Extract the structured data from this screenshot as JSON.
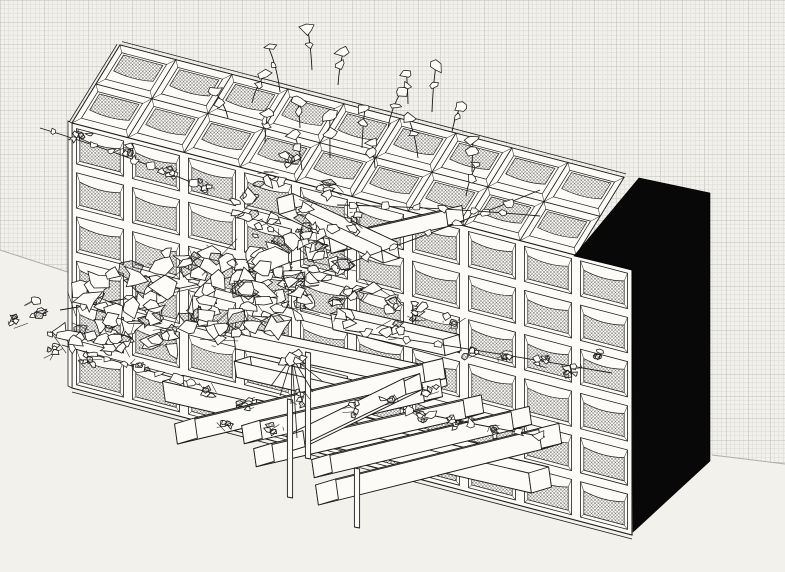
{
  "scene": {
    "canvas": {
      "width": 785,
      "height": 572
    },
    "palette": {
      "paper": "#f2f1ec",
      "grid_minor": "#dbdad5",
      "grid_major": "#c7c6c0",
      "ink": "#1c1c1c",
      "white": "#fcfbf8",
      "leaf_fill": "#fdfcf9",
      "mesh_line": "#454545",
      "monolith": "#080808",
      "ground_line": "#aeada9"
    },
    "background": {
      "grid_region": [
        [
          0,
          0
        ],
        [
          785,
          0
        ],
        [
          785,
          464
        ],
        [
          712,
          455
        ],
        [
          633,
          530
        ],
        [
          90,
          279
        ],
        [
          0,
          250
        ]
      ],
      "grid_cell": 22,
      "grid_minor_step": 4.4,
      "ground_left": [
        [
          0,
          250
        ],
        [
          80,
          276
        ]
      ],
      "ground_right": [
        [
          712,
          455
        ],
        [
          785,
          464
        ]
      ]
    },
    "building": {
      "origin": [
        72,
        123
      ],
      "col_vec": [
        56,
        14.7
      ],
      "row_vec": [
        0,
        44.17
      ],
      "cols": 10,
      "rows": 6,
      "depth_vec": [
        48,
        -78
      ],
      "tray_cols": 9,
      "tray_rows": 2,
      "monolith": [
        [
          574,
          256
        ],
        [
          639,
          178
        ],
        [
          710,
          193
        ],
        [
          710,
          461
        ],
        [
          633,
          532
        ],
        [
          632,
          270
        ]
      ]
    },
    "beams": {
      "parallel": [
        {
          "e": [
            452,
            345
          ],
          "a": 193,
          "l": 115,
          "s": 8
        },
        {
          "e": [
            438,
            380
          ],
          "a": 192,
          "l": 200,
          "s": 8
        },
        {
          "e": [
            370,
            396
          ],
          "a": 193,
          "l": 130,
          "s": 8
        },
        {
          "e": [
            476,
            458
          ],
          "a": 193,
          "l": 310,
          "s": 10
        },
        {
          "e": [
            540,
            480
          ],
          "a": 193,
          "l": 300,
          "s": 10
        }
      ],
      "protruding": [
        {
          "e": [
            186,
            431
          ],
          "a": -13.5,
          "l": 255,
          "s": 10
        },
        {
          "e": [
            252,
            432
          ],
          "a": -13,
          "l": 185,
          "s": 9
        },
        {
          "e": [
            264,
            455
          ],
          "a": -13,
          "l": 215,
          "s": 9
        },
        {
          "e": [
            296,
            441
          ],
          "a": -26,
          "l": 130,
          "s": 8
        },
        {
          "e": [
            322,
            466
          ],
          "a": -13.5,
          "l": 205,
          "s": 9
        },
        {
          "e": [
            327,
            492
          ],
          "a": -14,
          "l": 230,
          "s": 10
        },
        {
          "e": [
            338,
            243
          ],
          "a": -13,
          "l": 120,
          "s": 8
        },
        {
          "e": [
            286,
            204
          ],
          "a": 25,
          "l": 115,
          "s": 8
        }
      ],
      "posts": [
        [
          290,
          399,
          497
        ],
        [
          308,
          352,
          458
        ],
        [
          357,
          468,
          527
        ]
      ]
    },
    "umbrella": {
      "center": [
        292,
        357
      ],
      "tips": [
        [
          271,
          386
        ],
        [
          280,
          396
        ],
        [
          291,
          404
        ],
        [
          302,
          401
        ],
        [
          313,
          392
        ],
        [
          322,
          381
        ],
        [
          297,
          438
        ]
      ]
    },
    "vegetation": {
      "clusters": [
        [
          95,
          300,
          30
        ],
        [
          140,
          285,
          32
        ],
        [
          185,
          272,
          32
        ],
        [
          230,
          262,
          34
        ],
        [
          275,
          252,
          34
        ],
        [
          315,
          248,
          30
        ],
        [
          290,
          280,
          30
        ],
        [
          245,
          292,
          32
        ],
        [
          198,
          308,
          30
        ],
        [
          152,
          318,
          28
        ],
        [
          108,
          325,
          26
        ],
        [
          70,
          338,
          22
        ],
        [
          330,
          270,
          26
        ],
        [
          355,
          290,
          18
        ],
        [
          220,
          330,
          24
        ],
        [
          170,
          340,
          22
        ],
        [
          120,
          345,
          20
        ],
        [
          260,
          320,
          26
        ],
        [
          300,
          305,
          24
        ],
        [
          345,
          310,
          20
        ],
        [
          38,
          308,
          14
        ],
        [
          18,
          322,
          10
        ],
        [
          52,
          352,
          12
        ],
        [
          250,
          208,
          20
        ],
        [
          268,
          182,
          16
        ],
        [
          288,
          158,
          14
        ],
        [
          270,
          230,
          18
        ],
        [
          305,
          210,
          16
        ],
        [
          330,
          190,
          14
        ],
        [
          310,
          235,
          16
        ],
        [
          352,
          222,
          14
        ],
        [
          385,
          300,
          16
        ],
        [
          420,
          312,
          14
        ],
        [
          455,
          322,
          12
        ],
        [
          390,
          330,
          14
        ],
        [
          572,
          368,
          10
        ],
        [
          600,
          352,
          8
        ],
        [
          545,
          362,
          8
        ],
        [
          470,
          352,
          8
        ],
        [
          505,
          358,
          8
        ],
        [
          420,
          415,
          9
        ],
        [
          455,
          422,
          9
        ],
        [
          495,
          430,
          8
        ],
        [
          205,
          390,
          12
        ],
        [
          248,
          402,
          10
        ],
        [
          300,
          398,
          10
        ],
        [
          350,
          408,
          10
        ],
        [
          390,
          400,
          9
        ],
        [
          430,
          392,
          9
        ],
        [
          225,
          425,
          9
        ],
        [
          275,
          430,
          9
        ],
        [
          90,
          360,
          12
        ],
        [
          140,
          365,
          10
        ],
        [
          85,
          135,
          10
        ],
        [
          125,
          152,
          10
        ],
        [
          168,
          172,
          10
        ],
        [
          205,
          188,
          10
        ]
      ],
      "roof_sprigs": [
        [
          228,
          118
        ],
        [
          252,
          103
        ],
        [
          280,
          92
        ],
        [
          312,
          70
        ],
        [
          338,
          85
        ],
        [
          300,
          128
        ],
        [
          265,
          142
        ],
        [
          330,
          158
        ],
        [
          362,
          148
        ],
        [
          388,
          128
        ],
        [
          408,
          104
        ],
        [
          432,
          112
        ],
        [
          452,
          132
        ],
        [
          375,
          168
        ],
        [
          302,
          170
        ],
        [
          418,
          158
        ],
        [
          472,
          172
        ],
        [
          466,
          196
        ]
      ],
      "vines": [
        [
          [
            323,
            272
          ],
          [
            430,
            235
          ],
          [
            540,
            190
          ]
        ],
        [
          [
            337,
            205
          ],
          [
            440,
            207
          ],
          [
            540,
            216
          ]
        ],
        [
          [
            60,
            310
          ],
          [
            200,
            288
          ],
          [
            330,
            252
          ]
        ],
        [
          [
            345,
            330
          ],
          [
            480,
            350
          ],
          [
            612,
            373
          ]
        ],
        [
          [
            398,
            408
          ],
          [
            470,
            424
          ],
          [
            545,
            437
          ]
        ],
        [
          [
            62,
            345
          ],
          [
            130,
            366
          ],
          [
            200,
            385
          ]
        ],
        [
          [
            40,
            128
          ],
          [
            120,
            152
          ],
          [
            205,
            188
          ]
        ]
      ]
    }
  }
}
